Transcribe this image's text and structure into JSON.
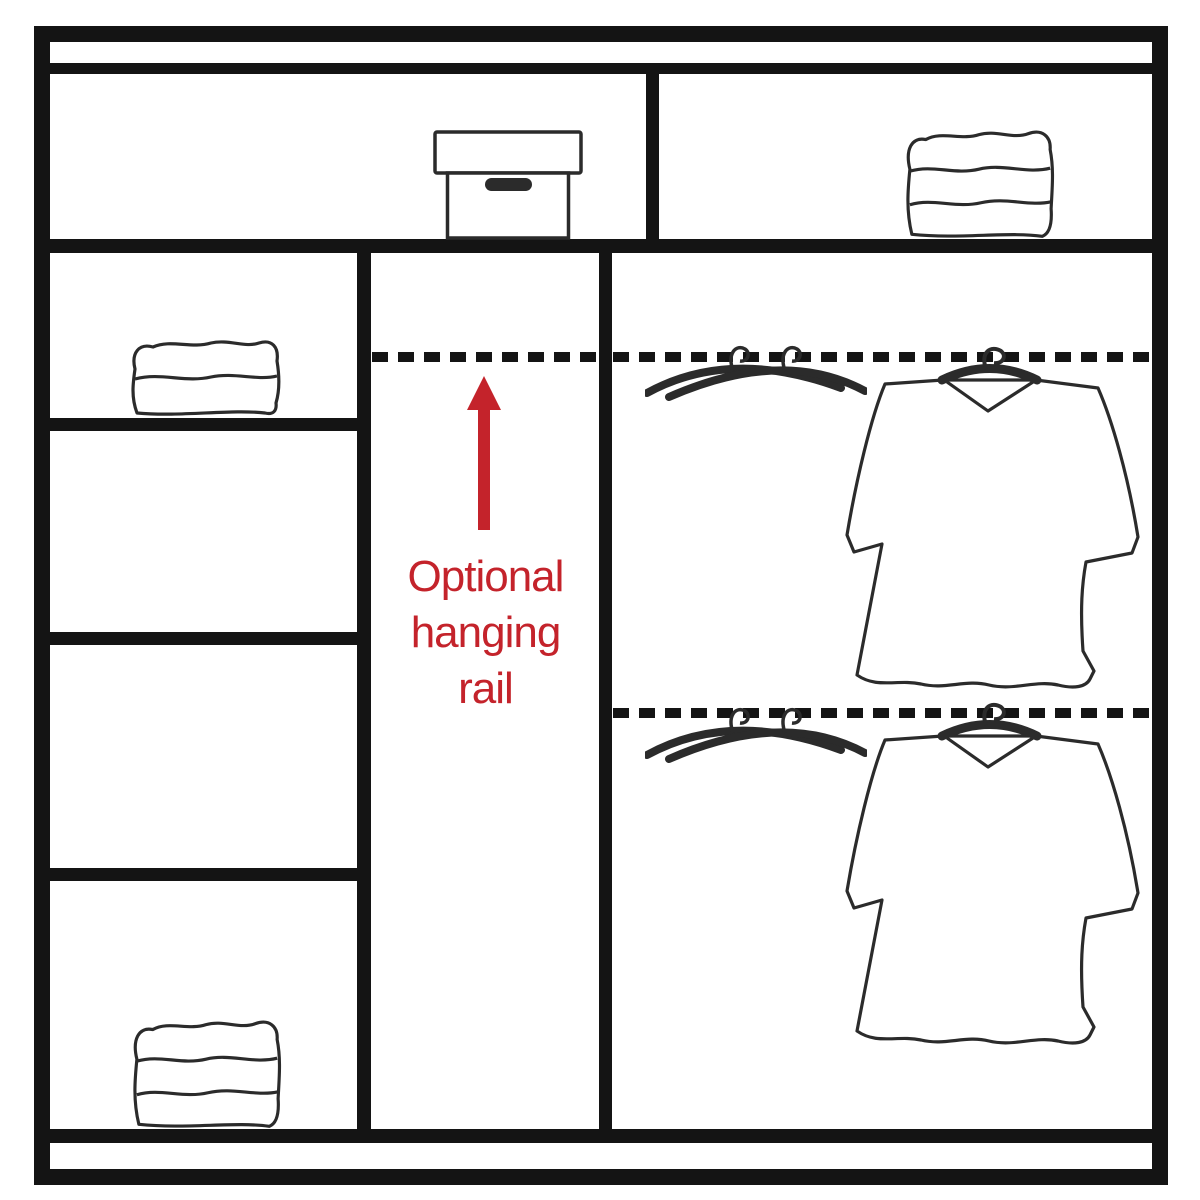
{
  "diagram": {
    "title": "Wardrobe interior storage layout diagram",
    "annotation": {
      "full_text": "Optional hanging rail",
      "lines": [
        "Optional",
        "hanging",
        "rail"
      ]
    },
    "colors": {
      "structure_line": "#141414",
      "art_line": "#2b2b2b",
      "accent_red": "#c4232b",
      "background": "#ffffff"
    },
    "icons": {
      "top_shelf_left": "storage-box-icon",
      "top_shelf_right": "folded-towels-icon",
      "left_column_top": "folded-towels-icon",
      "left_column_bottom": "folded-towels-icon",
      "right_column_top": "clothes-hangers-icon, shirt-on-hanger-icon",
      "right_column_bottom": "clothes-hangers-icon, shirt-on-hanger-icon",
      "middle_column": "red-up-arrow-icon"
    }
  }
}
